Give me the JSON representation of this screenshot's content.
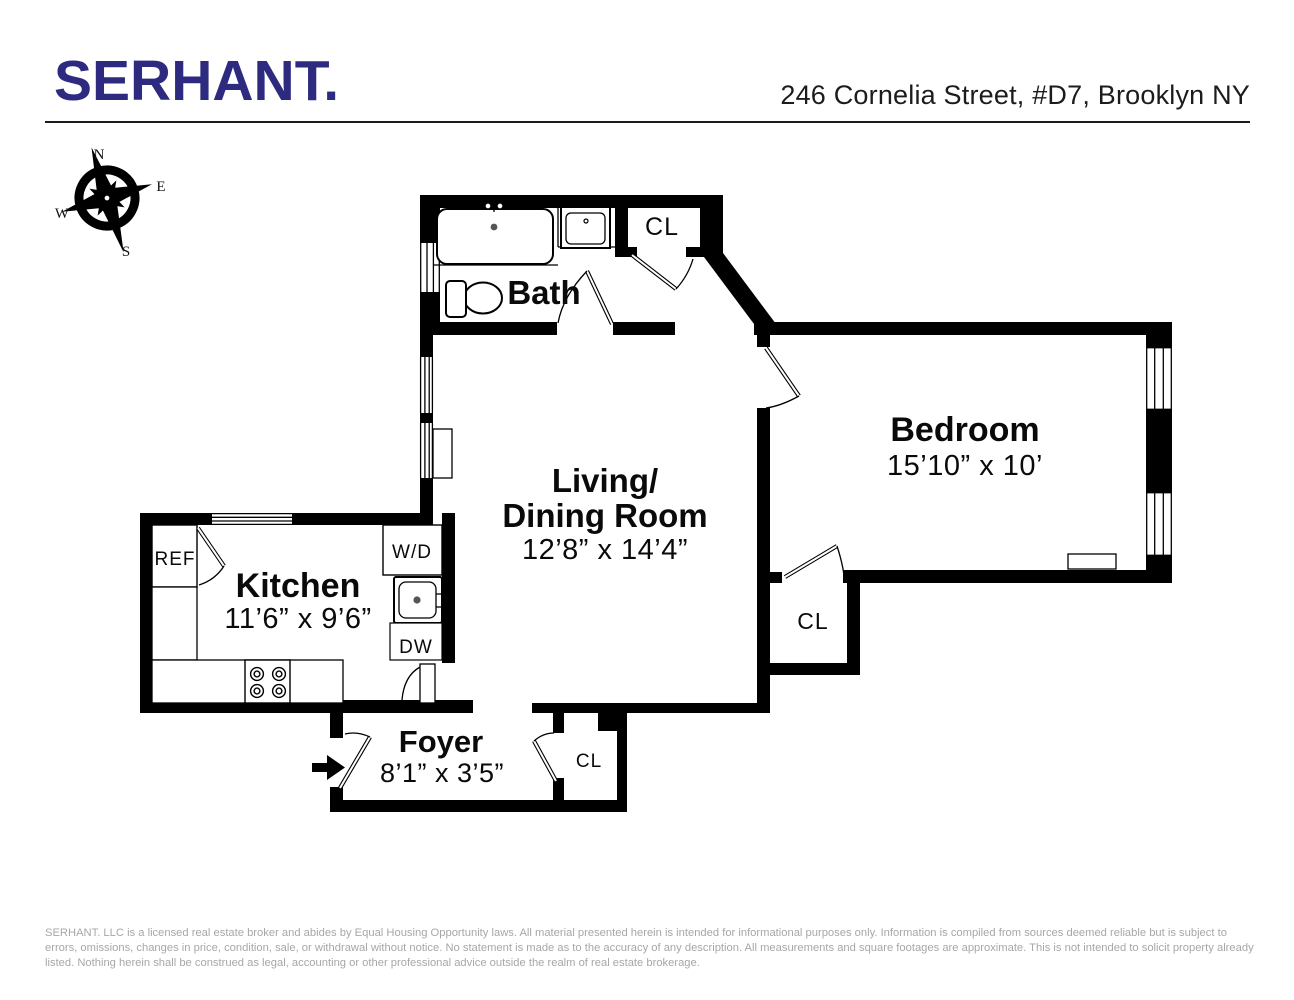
{
  "header": {
    "logo": "SERHANT.",
    "address": "246 Cornelia Street, #D7, Brooklyn NY",
    "brand_color": "#2D2A7F"
  },
  "compass": {
    "n": "N",
    "e": "E",
    "s": "S",
    "w": "W"
  },
  "plan": {
    "bath": {
      "name": "Bath"
    },
    "bedroom": {
      "name": "Bedroom",
      "dims": "15’10” x 10’"
    },
    "living": {
      "line1": "Living/",
      "line2": "Dining Room",
      "dims": "12’8” x 14’4”"
    },
    "kitchen": {
      "name": "Kitchen",
      "dims": "11’6” x 9’6”"
    },
    "foyer": {
      "name": "Foyer",
      "dims": "8’1” x 3’5”"
    },
    "closet_label": "CL",
    "appliances": {
      "refrigerator": "REF",
      "washer_dryer": "W/D",
      "dishwasher": "DW"
    }
  },
  "footer": {
    "disclaimer": "SERHANT. LLC is a licensed real estate broker and abides by Equal Housing Opportunity laws. All material presented herein is intended for informational purposes only. Information is compiled from sources deemed reliable but is subject to errors, omissions, changes in price, condition, sale, or withdrawal without notice. No statement is made as to the accuracy of any description. All measurements and square footages are approximate. This is not intended to solicit property already listed. Nothing herein shall be construed as legal, accounting or other professional advice outside the realm of real estate brokerage."
  }
}
